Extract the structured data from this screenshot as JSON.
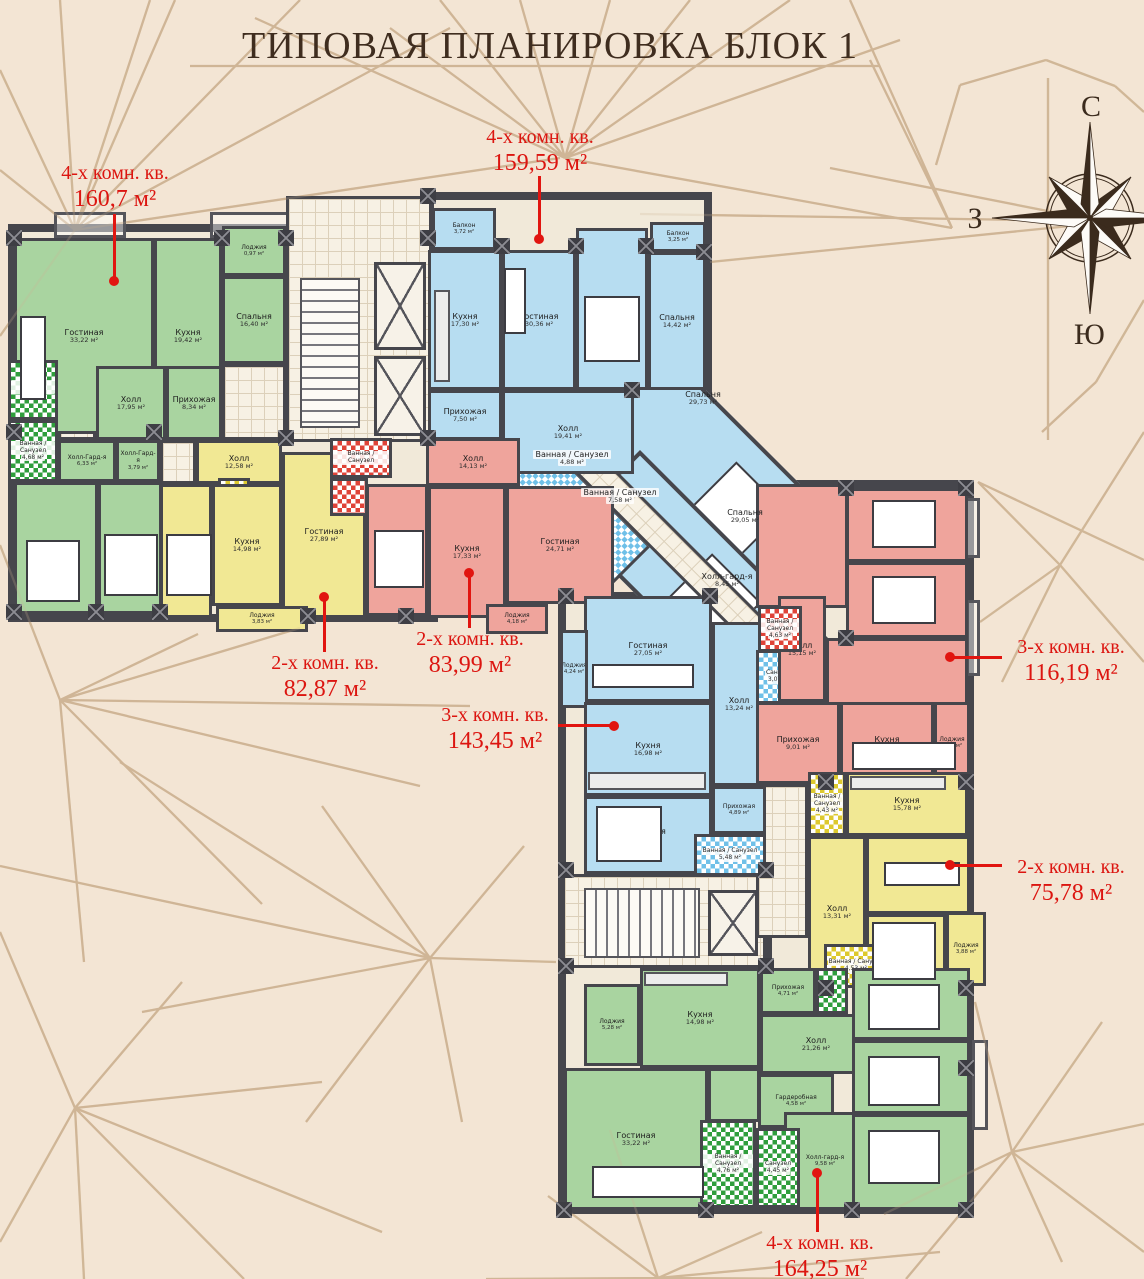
{
  "title": "ТИПОВАЯ ПЛАНИРОВКА БЛОК 1",
  "compass": {
    "north": "С",
    "west": "З",
    "south": "Ю"
  },
  "colors": {
    "background": "#f3e5d4",
    "pattern_line": "#cdb292",
    "wall": "#46464c",
    "apartment_green": "#a9d4a0",
    "apartment_blue": "#b7ddf1",
    "apartment_yellow": "#f1e894",
    "apartment_red": "#efa49c",
    "annotation_red": "#e11510",
    "title_brown": "#3f2d1f"
  },
  "annotations": [
    {
      "type_label": "4-х комн. кв.",
      "area_label": "160,7 м²"
    },
    {
      "type_label": "4-х комн. кв.",
      "area_label": "159,59 м²"
    },
    {
      "type_label": "2-х комн. кв.",
      "area_label": "82,87 м²"
    },
    {
      "type_label": "2-х комн. кв.",
      "area_label": "83,99 м²"
    },
    {
      "type_label": "3-х комн. кв.",
      "area_label": "143,45 м²"
    },
    {
      "type_label": "3-х комн. кв.",
      "area_label": "116,19 м²"
    },
    {
      "type_label": "2-х комн. кв.",
      "area_label": "75,78 м²"
    },
    {
      "type_label": "4-х комн. кв.",
      "area_label": "164,25 м²"
    }
  ],
  "apartments": [
    {
      "type_label": "4-х комн. кв.",
      "area_label": "160,7 м²",
      "color": "green",
      "rooms": [
        {
          "name": "Гостиная",
          "area": "33,22 м²"
        },
        {
          "name": "Кухня",
          "area": "19,42 м²"
        },
        {
          "name": "Лоджия",
          "area": "0,97 м²"
        },
        {
          "name": "Спальня",
          "area": "16,40 м²"
        },
        {
          "name": "Холл",
          "area": "17,95 м²"
        },
        {
          "name": "Прихожая",
          "area": "8,34 м²"
        },
        {
          "name": "Холл-Гард-я",
          "area": "6,33 м²"
        },
        {
          "name": "Холл-Гард-я",
          "area": "3,79 м²"
        },
        {
          "name": "Спальня",
          "area": "16,13 м²"
        },
        {
          "name": "Спальня",
          "area": "16,41 м²"
        },
        {
          "name": "Ванная / Санузел",
          "area": "5,15 м²"
        },
        {
          "name": "Ванная / Санузел",
          "area": "4,68 м²"
        }
      ]
    },
    {
      "type_label": "4-х комн. кв.",
      "area_label": "159,59 м²",
      "color": "blue",
      "rooms": [
        {
          "name": "Балкон",
          "area": "3,72 м²"
        },
        {
          "name": "Кухня",
          "area": "17,30 м²"
        },
        {
          "name": "Гостиная",
          "area": "30,36 м²"
        },
        {
          "name": "Спальня",
          "area": "18,31 м²"
        },
        {
          "name": "Спальня",
          "area": "14,42 м²"
        },
        {
          "name": "Балкон",
          "area": "3,25 м²"
        },
        {
          "name": "Прихожая",
          "area": "7,50 м²"
        },
        {
          "name": "Холл",
          "area": "19,41 м²"
        },
        {
          "name": "Спальня",
          "area": "29,73 м²"
        }
      ]
    },
    {
      "type_label": "2-х комн. кв.",
      "area_label": "82,87 м²",
      "color": "yellow",
      "rooms": [
        {
          "name": "Холл",
          "area": "12,58 м²"
        },
        {
          "name": "Санузел",
          "area": "3,15 м²"
        },
        {
          "name": "Кухня",
          "area": "14,98 м²"
        },
        {
          "name": "Гостиная",
          "area": "27,89 м²"
        },
        {
          "name": "Спальня",
          "area": "17,35 м²"
        },
        {
          "name": "Лоджия",
          "area": "3,83 м²"
        }
      ]
    },
    {
      "type_label": "2-х комн. кв.",
      "area_label": "83,99 м²",
      "color": "red",
      "rooms": [
        {
          "name": "Холл",
          "area": "14,13 м²"
        },
        {
          "name": "Кухня",
          "area": "17,33 м²"
        },
        {
          "name": "Гостиная",
          "area": "24,71 м²"
        },
        {
          "name": "Спальня",
          "area": "16,63 м²"
        },
        {
          "name": "Лоджия",
          "area": "4,18 м²"
        },
        {
          "name": "Ванная / Санузел",
          "area": ""
        }
      ]
    },
    {
      "type_label": "3-х комн. кв.",
      "area_label": "143,45 м²",
      "color": "blue",
      "rooms": [
        {
          "name": "Спальня",
          "area": "29,05 м²"
        },
        {
          "name": "Холл-гард-я",
          "area": "8,45 м²"
        },
        {
          "name": "Ванная / Санузел",
          "area": "4,88 м²"
        },
        {
          "name": "Ванная / Санузел",
          "area": "7,58 м²"
        },
        {
          "name": "Гостиная",
          "area": "27,05 м²"
        },
        {
          "name": "Лоджия",
          "area": "4,24 м²"
        },
        {
          "name": "Кухня",
          "area": "16,98 м²"
        },
        {
          "name": "Холл",
          "area": "13,24 м²"
        },
        {
          "name": "Спальня",
          "area": "18,53 м²"
        },
        {
          "name": "Прихожая",
          "area": "4,89 м²"
        },
        {
          "name": "Санузел",
          "area": "3,07 м²"
        },
        {
          "name": "Ванная / Санузел",
          "area": "5,48 м²"
        }
      ]
    },
    {
      "type_label": "3-х комн. кв.",
      "area_label": "116,19 м²",
      "color": "red",
      "rooms": [
        {
          "name": "Спальня",
          "area": "21,98 м²"
        },
        {
          "name": "Спальня",
          "area": "18,31 м²"
        },
        {
          "name": "Гостиная",
          "area": "27,70 м²"
        },
        {
          "name": "Холл",
          "area": "15,15 м²"
        },
        {
          "name": "Прихожая",
          "area": "9,01 м²"
        },
        {
          "name": "Кухня",
          "area": "12,60 м²"
        },
        {
          "name": "Лоджия",
          "area": "4,91 м²"
        },
        {
          "name": "Ванная / Санузел",
          "area": "4,63 м²"
        }
      ]
    },
    {
      "type_label": "2-х комн. кв.",
      "area_label": "75,78 м²",
      "color": "yellow",
      "rooms": [
        {
          "name": "Кухня",
          "area": "15,78 м²"
        },
        {
          "name": "Гостиная",
          "area": "21,54 м²"
        },
        {
          "name": "Холл",
          "area": "13,31 м²"
        },
        {
          "name": "Спальня",
          "area": "12,31 м²"
        },
        {
          "name": "Лоджия",
          "area": "3,88 м²"
        },
        {
          "name": "Ванная / Санузел",
          "area": "4,53 м²"
        },
        {
          "name": "Ванная / Санузел",
          "area": "4,43 м²"
        }
      ]
    },
    {
      "type_label": "4-х комн. кв.",
      "area_label": "164,25 м²",
      "color": "green",
      "rooms": [
        {
          "name": "Лоджия",
          "area": "5,28 м²"
        },
        {
          "name": "Кухня",
          "area": "14,98 м²"
        },
        {
          "name": "Прихожая",
          "area": "4,71 м²"
        },
        {
          "name": "Холл",
          "area": "21,26 м²"
        },
        {
          "name": "Гардеробная",
          "area": "4,58 м²"
        },
        {
          "name": "Гостиная",
          "area": "33,22 м²"
        },
        {
          "name": "Холл-гард-я",
          "area": "9,58 м²"
        },
        {
          "name": "Спальня",
          "area": "19,23 м²"
        },
        {
          "name": "Спальня",
          "area": "17,15 м²"
        },
        {
          "name": "Спальня",
          "area": "19,98 м²"
        },
        {
          "name": "Ванная / Санузел",
          "area": "4,76 м²"
        },
        {
          "name": "Санузел",
          "area": "4,45 м²"
        }
      ]
    }
  ]
}
